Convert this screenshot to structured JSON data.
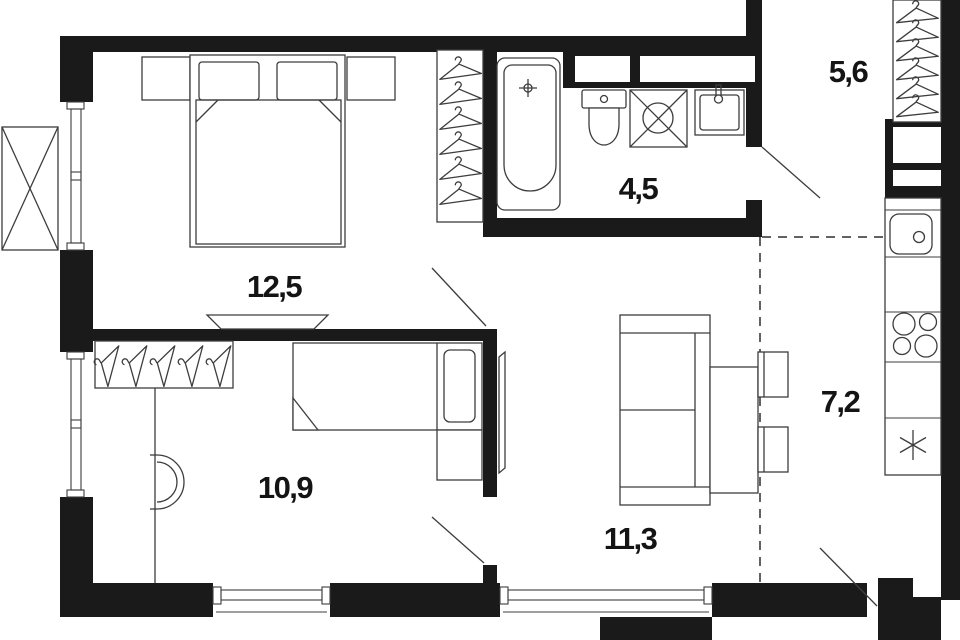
{
  "plan": {
    "kind": "apartment-floor-plan",
    "rooms": [
      {
        "name": "bedroom",
        "area": "12,5"
      },
      {
        "name": "kids-room",
        "area": "10,9"
      },
      {
        "name": "living-room",
        "area": "11,3"
      },
      {
        "name": "bathroom",
        "area": "4,5"
      },
      {
        "name": "hallway",
        "area": "5,6"
      },
      {
        "name": "kitchen",
        "area": "7,2"
      }
    ],
    "colors": {
      "wall": "#1a1a1a",
      "line": "#3d3d3d",
      "background": "#ffffff"
    },
    "icons": [
      "hanger-icon",
      "bathtub-icon",
      "faucet-icon",
      "toilet-icon",
      "shower-icon",
      "washbasin-icon",
      "kitchen-sink-icon",
      "stove-burners-icon",
      "star-appliance-icon",
      "double-bed-icon",
      "single-bed-icon",
      "sofa-icon",
      "dining-table-icon",
      "chair-icon",
      "tv-icon",
      "ac-unit-icon",
      "door-swing-icon",
      "window-icon",
      "vent-shaft-icon"
    ]
  }
}
